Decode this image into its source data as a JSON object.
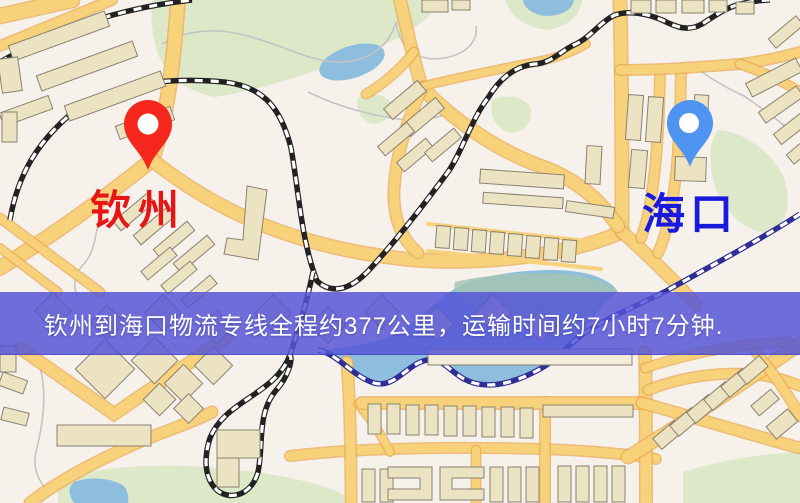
{
  "banner": {
    "text": "钦州到海口物流专线全程约377公里，运输时间约7小时7分钟.",
    "background": "rgba(84,83,214,0.84)",
    "text_color": "#ffffff"
  },
  "markers": [
    {
      "name": "qinzhou",
      "label": "钦州",
      "pin_color": "#f5271c",
      "pin_hole_color": "#ffffff",
      "label_color": "#e81515"
    },
    {
      "name": "haikou",
      "label": "海口",
      "pin_color": "#4f94f0",
      "pin_hole_color": "#ffffff",
      "label_color": "#1a1add"
    }
  ],
  "map_colors": {
    "background": "#f7f1ec",
    "park": "#dde8c9",
    "park_teal": "#a3c6b4",
    "water": "#8ebede",
    "road_fill": "#f7d27b",
    "road_casing": "#e9a952",
    "railway": "#222222",
    "railway_water": "#2e2e96",
    "trail": "#c4c4c4",
    "building_fill": "#ece3c3",
    "building_light": "#f2ecd8",
    "building_stroke": "#8a8171"
  }
}
